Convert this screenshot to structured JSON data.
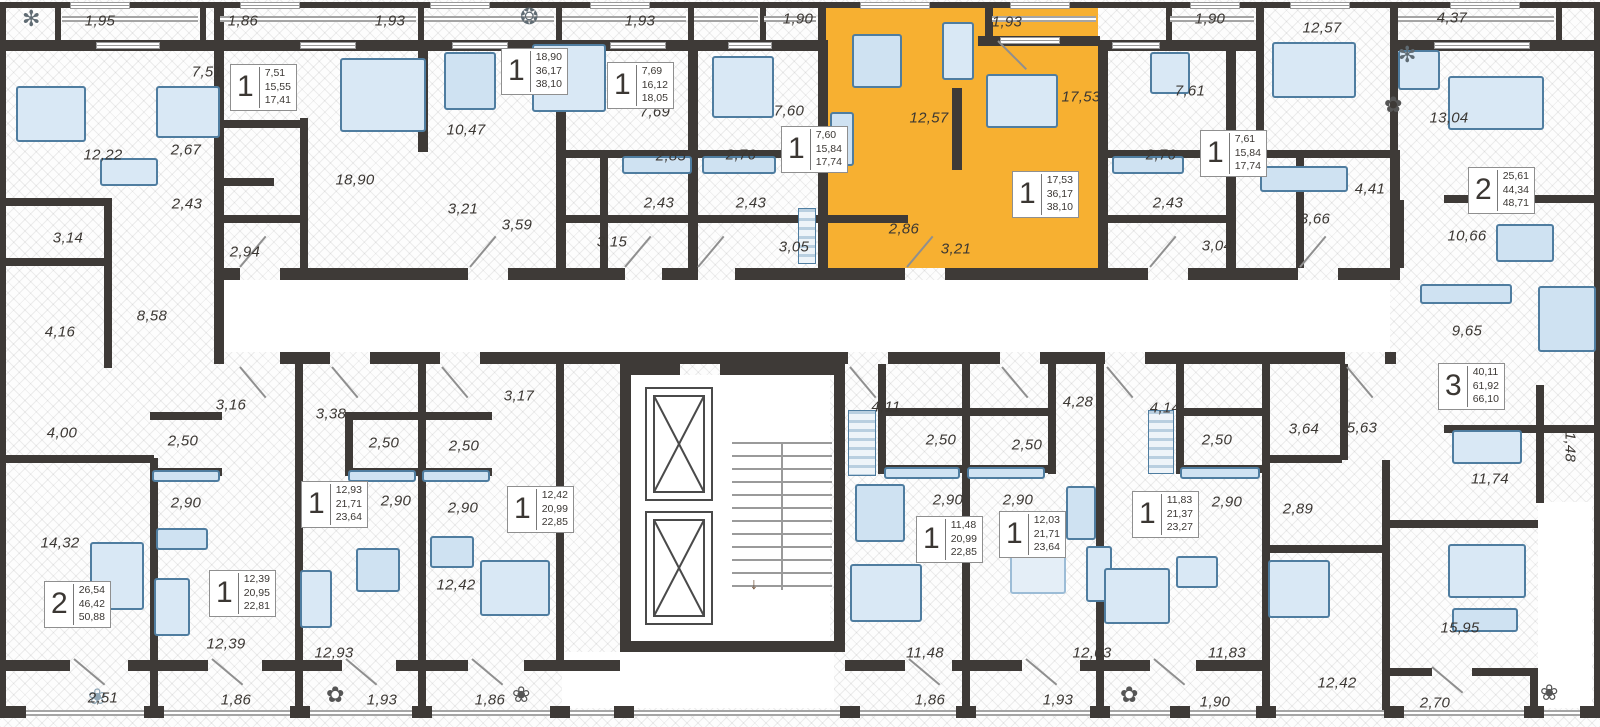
{
  "plan": {
    "colors": {
      "highlight": "#F7B031",
      "wall": "#3E3A37",
      "furniture_fill": "#D9E8F5",
      "furniture_edge": "#4F7DA0",
      "label_text": "#3B3733"
    },
    "selected_apartment": {
      "rooms_digit": "1",
      "areas": [
        "17,53",
        "36,17",
        "38,10"
      ]
    },
    "room_labels": [
      {
        "t": "1,95",
        "x": 100,
        "y": 21
      },
      {
        "t": "1,86",
        "x": 243,
        "y": 21
      },
      {
        "t": "1,93",
        "x": 390,
        "y": 21
      },
      {
        "t": "1,93",
        "x": 640,
        "y": 21
      },
      {
        "t": "1,90",
        "x": 798,
        "y": 19
      },
      {
        "t": "1,93",
        "x": 1007,
        "y": 22
      },
      {
        "t": "1,90",
        "x": 1210,
        "y": 19
      },
      {
        "t": "12,57",
        "x": 1322,
        "y": 28
      },
      {
        "t": "4,37",
        "x": 1452,
        "y": 18
      },
      {
        "t": "7,51",
        "x": 207,
        "y": 72
      },
      {
        "t": "12,22",
        "x": 103,
        "y": 155
      },
      {
        "t": "2,67",
        "x": 186,
        "y": 150
      },
      {
        "t": "2,43",
        "x": 187,
        "y": 204
      },
      {
        "t": "3,14",
        "x": 68,
        "y": 238
      },
      {
        "t": "2,94",
        "x": 245,
        "y": 252
      },
      {
        "t": "18,90",
        "x": 355,
        "y": 180
      },
      {
        "t": "10,47",
        "x": 466,
        "y": 130
      },
      {
        "t": "3,21",
        "x": 463,
        "y": 209
      },
      {
        "t": "3,59",
        "x": 517,
        "y": 225
      },
      {
        "t": "7,69",
        "x": 655,
        "y": 112
      },
      {
        "t": "2,85",
        "x": 671,
        "y": 156
      },
      {
        "t": "2,43",
        "x": 659,
        "y": 203
      },
      {
        "t": "3,15",
        "x": 612,
        "y": 242
      },
      {
        "t": "7,60",
        "x": 789,
        "y": 111
      },
      {
        "t": "2,76",
        "x": 741,
        "y": 155
      },
      {
        "t": "2,43",
        "x": 751,
        "y": 203
      },
      {
        "t": "3,05",
        "x": 794,
        "y": 247
      },
      {
        "t": "12,57",
        "x": 929,
        "y": 118
      },
      {
        "t": "17,53",
        "x": 1081,
        "y": 97
      },
      {
        "t": "2,86",
        "x": 904,
        "y": 229
      },
      {
        "t": "3,21",
        "x": 956,
        "y": 249
      },
      {
        "t": "7,61",
        "x": 1190,
        "y": 91
      },
      {
        "t": "2,76",
        "x": 1161,
        "y": 155
      },
      {
        "t": "2,43",
        "x": 1168,
        "y": 203
      },
      {
        "t": "3,04",
        "x": 1217,
        "y": 246
      },
      {
        "t": "13,04",
        "x": 1449,
        "y": 118
      },
      {
        "t": "4,41",
        "x": 1370,
        "y": 189
      },
      {
        "t": "3,66",
        "x": 1315,
        "y": 219
      },
      {
        "t": "10,66",
        "x": 1467,
        "y": 236
      },
      {
        "t": "9,65",
        "x": 1467,
        "y": 331
      },
      {
        "t": "8,58",
        "x": 152,
        "y": 316
      },
      {
        "t": "4,16",
        "x": 60,
        "y": 332
      },
      {
        "t": "4,00",
        "x": 62,
        "y": 433
      },
      {
        "t": "3,16",
        "x": 231,
        "y": 405
      },
      {
        "t": "3,38",
        "x": 331,
        "y": 414
      },
      {
        "t": "3,17",
        "x": 519,
        "y": 396
      },
      {
        "t": "4,11",
        "x": 886,
        "y": 407
      },
      {
        "t": "4,28",
        "x": 1078,
        "y": 402
      },
      {
        "t": "4,14",
        "x": 1165,
        "y": 408
      },
      {
        "t": "5,63",
        "x": 1362,
        "y": 428
      },
      {
        "t": "3,64",
        "x": 1304,
        "y": 429
      },
      {
        "t": "1,48",
        "x": 1570,
        "y": 447,
        "r": 1
      },
      {
        "t": "2,50",
        "x": 183,
        "y": 441
      },
      {
        "t": "2,50",
        "x": 384,
        "y": 443
      },
      {
        "t": "2,50",
        "x": 464,
        "y": 446
      },
      {
        "t": "2,90",
        "x": 186,
        "y": 503
      },
      {
        "t": "2,90",
        "x": 396,
        "y": 501
      },
      {
        "t": "2,90",
        "x": 463,
        "y": 508
      },
      {
        "t": "2,50",
        "x": 941,
        "y": 440
      },
      {
        "t": "2,50",
        "x": 1027,
        "y": 445
      },
      {
        "t": "2,90",
        "x": 948,
        "y": 500
      },
      {
        "t": "2,90",
        "x": 1018,
        "y": 500
      },
      {
        "t": "2,50",
        "x": 1217,
        "y": 440
      },
      {
        "t": "2,90",
        "x": 1227,
        "y": 502
      },
      {
        "t": "2,89",
        "x": 1298,
        "y": 509
      },
      {
        "t": "11,74",
        "x": 1490,
        "y": 479
      },
      {
        "t": "14,32",
        "x": 60,
        "y": 543
      },
      {
        "t": "12,39",
        "x": 226,
        "y": 644
      },
      {
        "t": "12,93",
        "x": 334,
        "y": 653
      },
      {
        "t": "12,42",
        "x": 456,
        "y": 585
      },
      {
        "t": "11,48",
        "x": 925,
        "y": 653
      },
      {
        "t": "12,03",
        "x": 1092,
        "y": 653
      },
      {
        "t": "11,83",
        "x": 1227,
        "y": 653
      },
      {
        "t": "12,42",
        "x": 1337,
        "y": 683
      },
      {
        "t": "15,95",
        "x": 1460,
        "y": 628
      },
      {
        "t": "2,51",
        "x": 103,
        "y": 698
      },
      {
        "t": "1,86",
        "x": 236,
        "y": 700
      },
      {
        "t": "1,93",
        "x": 382,
        "y": 700
      },
      {
        "t": "1,86",
        "x": 490,
        "y": 700
      },
      {
        "t": "1,86",
        "x": 930,
        "y": 700
      },
      {
        "t": "1,93",
        "x": 1058,
        "y": 700
      },
      {
        "t": "1,90",
        "x": 1215,
        "y": 702
      },
      {
        "t": "2,70",
        "x": 1435,
        "y": 703
      }
    ],
    "unit_cards": [
      {
        "n": "1",
        "v": [
          "7,51",
          "15,55",
          "17,41"
        ],
        "x": 230,
        "y": 64
      },
      {
        "n": "1",
        "v": [
          "18,90",
          "36,17",
          "38,10"
        ],
        "x": 501,
        "y": 48
      },
      {
        "n": "1",
        "v": [
          "7,69",
          "16,12",
          "18,05"
        ],
        "x": 607,
        "y": 62
      },
      {
        "n": "1",
        "v": [
          "7,60",
          "15,84",
          "17,74"
        ],
        "x": 781,
        "y": 126
      },
      {
        "n": "1",
        "v": [
          "17,53",
          "36,17",
          "38,10"
        ],
        "x": 1012,
        "y": 171,
        "hl": 1
      },
      {
        "n": "1",
        "v": [
          "7,61",
          "15,84",
          "17,74"
        ],
        "x": 1200,
        "y": 130
      },
      {
        "n": "2",
        "v": [
          "25,61",
          "44,34",
          "48,71"
        ],
        "x": 1468,
        "y": 167
      },
      {
        "n": "3",
        "v": [
          "40,11",
          "61,92",
          "66,10"
        ],
        "x": 1438,
        "y": 363
      },
      {
        "n": "2",
        "v": [
          "26,54",
          "46,42",
          "50,88"
        ],
        "x": 44,
        "y": 581
      },
      {
        "n": "1",
        "v": [
          "12,39",
          "20,95",
          "22,81"
        ],
        "x": 209,
        "y": 570
      },
      {
        "n": "1",
        "v": [
          "12,93",
          "21,71",
          "23,64"
        ],
        "x": 301,
        "y": 481
      },
      {
        "n": "1",
        "v": [
          "12,42",
          "20,99",
          "22,85"
        ],
        "x": 507,
        "y": 486
      },
      {
        "n": "1",
        "v": [
          "11,48",
          "20,99",
          "22,85"
        ],
        "x": 916,
        "y": 516
      },
      {
        "n": "1",
        "v": [
          "12,03",
          "21,71",
          "23,64"
        ],
        "x": 999,
        "y": 511
      },
      {
        "n": "1",
        "v": [
          "11,83",
          "21,37",
          "23,27"
        ],
        "x": 1132,
        "y": 491
      }
    ]
  }
}
